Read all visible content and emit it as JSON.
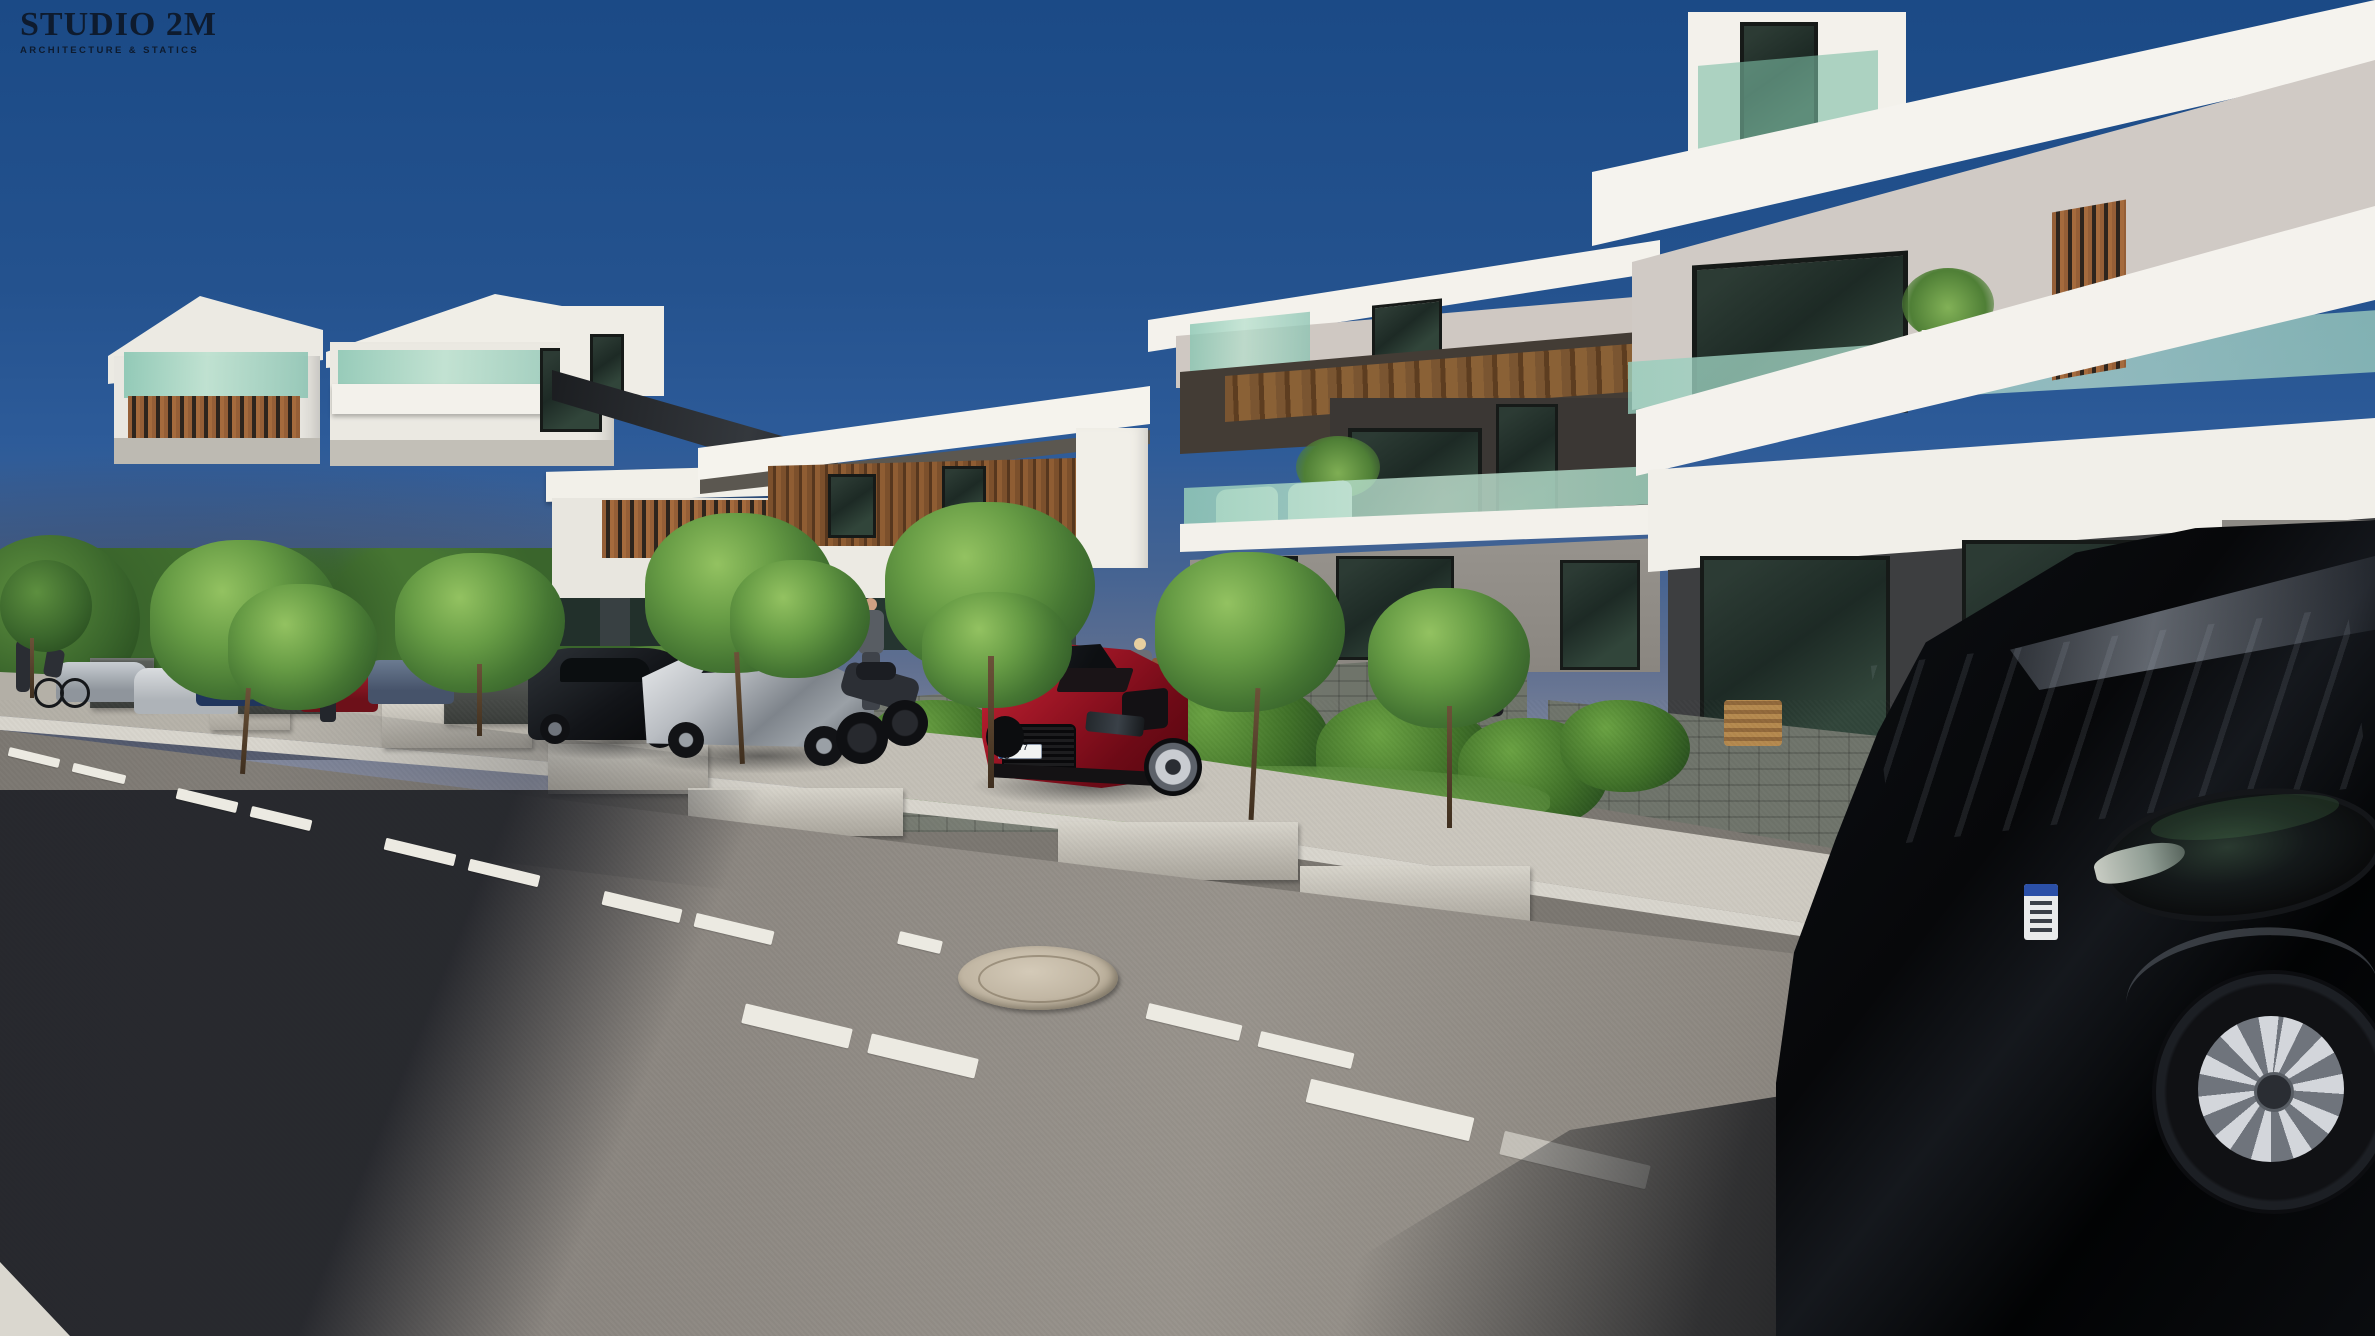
{
  "branding": {
    "title": "STUDIO 2M",
    "subtitle": "ARCHITECTURE & STATICS",
    "logo_color": "#0e1b2e"
  },
  "vehicles": {
    "red_sports_car_plate": "TS 0Y7 5U",
    "red_sports_car_color": "#8e1120",
    "silver_sports_car_color": "#b9bdc2",
    "black_coupe_color": "#121418",
    "black_sedan_color": "#0a0c0f",
    "motorcycle_color": "#2c2f35",
    "distant_car_colors": [
      "#c8cdd2",
      "#d9dcdf",
      "#3c5a86",
      "#a8202e",
      "#6b7b91"
    ]
  },
  "palette": {
    "sky-top": "#1b4a86",
    "sky-mid": "#2d5b99",
    "sky-haze": "#8b8fa0",
    "building-white": "#f2f0ea",
    "building-shade": "#d9d6cf",
    "wood": "#8a5a33",
    "glass-teal": "#9ccfbf",
    "window-dark": "#20302a",
    "stone-wall": "#757a70",
    "sidewalk": "#c0bcb3",
    "road": "#8b8680",
    "road-shadow": "#1e2026",
    "grass": "#4e7c35",
    "tree-green": "#3f6d2c",
    "marking-white": "#eceae2",
    "manhole": "#c0b5a2",
    "logo-color": "#0e1b2e"
  }
}
